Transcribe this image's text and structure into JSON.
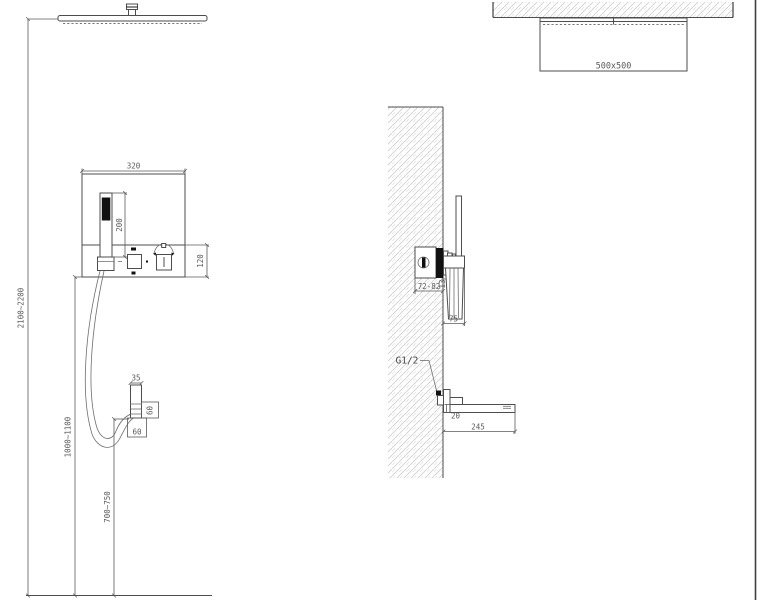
{
  "drawing": {
    "type": "shower-system-installation-diagram",
    "colors": {
      "line": "#4d4d4d",
      "dark_fill": "#111111",
      "hatch": "#d0d0d0",
      "text": "#5a5a5a",
      "background": "#ffffff"
    },
    "front_view": {
      "rain_head_height": "2100~2200",
      "panel_width": "320",
      "hand_shower_length": "200",
      "control_section_height": "120",
      "mixer_height": "1000~1100",
      "outlet_height": "700~750",
      "holder_width": "35",
      "holder_height": "60",
      "holder_base": "60"
    },
    "ceiling_view": {
      "head_size": "500x500"
    },
    "side_view": {
      "valve_recess_depth": "72-82",
      "trim_thickness": "13",
      "holder_projection": "75",
      "inlet_thread": "G1/2",
      "spout_height": "20",
      "spout_length": "245"
    }
  }
}
